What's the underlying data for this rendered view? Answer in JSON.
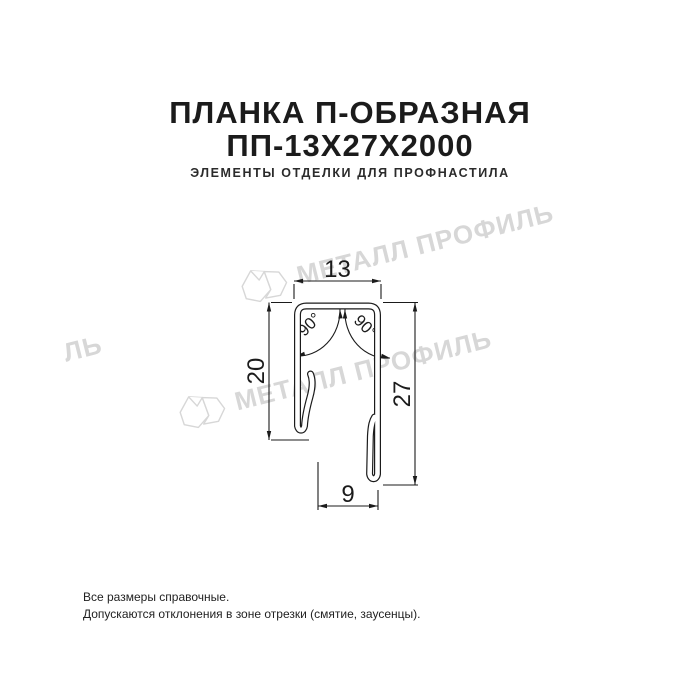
{
  "header": {
    "title_line1": "ПЛАНКА П-ОБРАЗНАЯ",
    "title_line2": "ПП-13Х27Х2000",
    "subtitle": "ЭЛЕМЕНТЫ ОТДЕЛКИ ДЛЯ ПРОФНАСТИЛА"
  },
  "drawing": {
    "description": "cross-section of U-shaped strip with hemmed leg edges",
    "dimensions": {
      "width_top": "13",
      "left_leg": "20",
      "right_leg": "27",
      "bottom_gap": "9",
      "angle_left": "90°",
      "angle_right": "90°"
    }
  },
  "watermark": {
    "text": "МЕТАЛЛ ПРОФИЛЬ",
    "fragment": "ЛЬ",
    "logo": "metall-profil-crystal-logo",
    "color": "#d7d7d7"
  },
  "footer": {
    "line1": "Все размеры справочные.",
    "line2": "Допускаются отклонения в зоне отрезки (смятие, заусенцы)."
  },
  "colors": {
    "ink": "#1b1b1b",
    "background": "#ffffff"
  }
}
